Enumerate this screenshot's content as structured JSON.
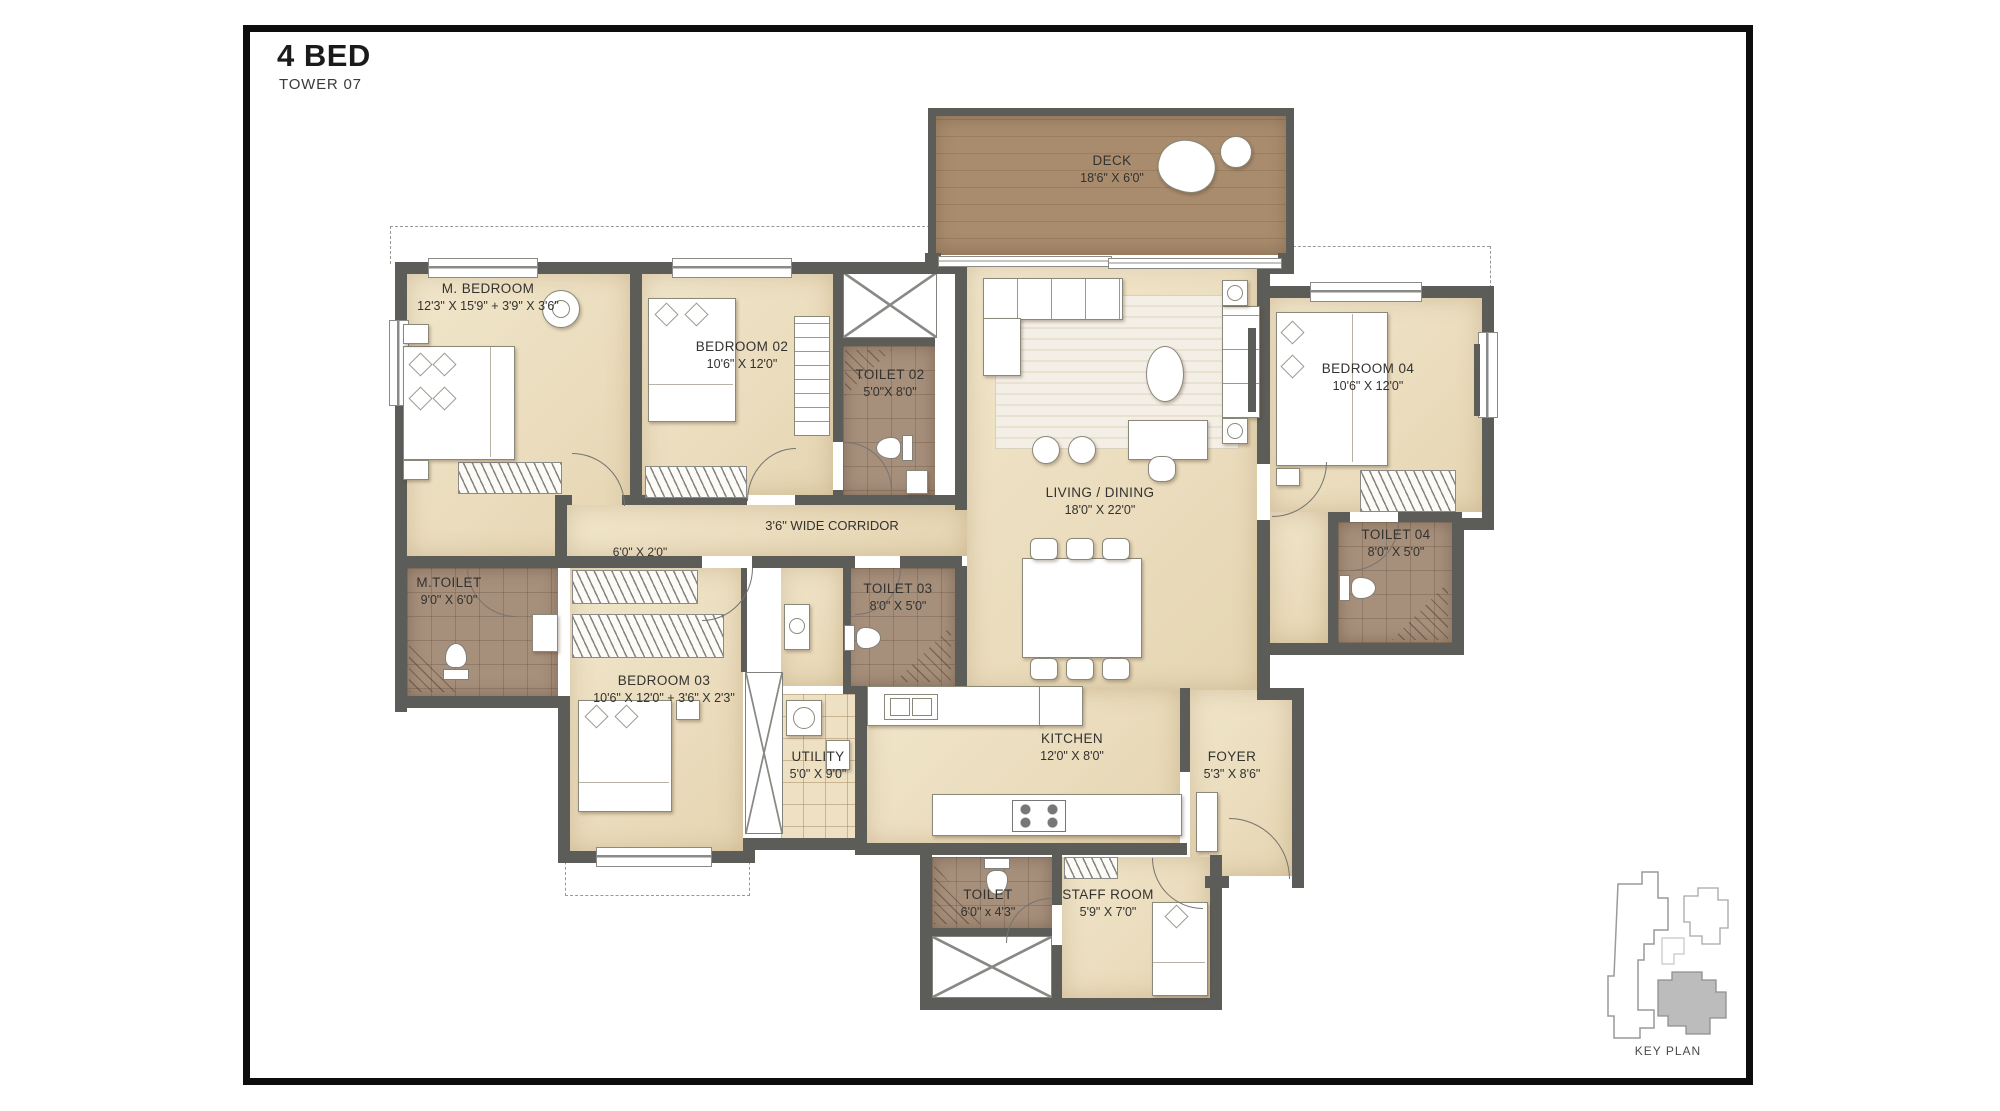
{
  "title": "4 BED",
  "subtitle": "TOWER 07",
  "rooms": {
    "m_bedroom": {
      "name": "M. BEDROOM",
      "dims": "12'3\" X 15'9\" + 3'9\" X 3'6\""
    },
    "bedroom02": {
      "name": "BEDROOM 02",
      "dims": "10'6\" X 12'0\""
    },
    "bedroom03": {
      "name": "BEDROOM 03",
      "dims": "10'6\" X 12'0\" + 3'6\" X 2'3\""
    },
    "bedroom04": {
      "name": "BEDROOM 04",
      "dims": "10'6\" X 12'0\""
    },
    "living": {
      "name": "LIVING / DINING",
      "dims": "18'0\" X 22'0\""
    },
    "deck": {
      "name": "DECK",
      "dims": "18'6\" X 6'0\""
    },
    "kitchen": {
      "name": "KITCHEN",
      "dims": "12'0\" X 8'0\""
    },
    "utility": {
      "name": "UTILITY",
      "dims": "5'0\" X 9'0\""
    },
    "foyer": {
      "name": "FOYER",
      "dims": "5'3\" X 8'6\""
    },
    "m_toilet": {
      "name": "M.TOILET",
      "dims": "9'0\" X 6'0\""
    },
    "toilet02": {
      "name": "TOILET 02",
      "dims": "5'0\"X 8'0\""
    },
    "toilet03": {
      "name": "TOILET 03",
      "dims": "8'0\" X 5'0\""
    },
    "toilet04": {
      "name": "TOILET 04",
      "dims": "8'0\" X 5'0\""
    },
    "toilet_st": {
      "name": "TOILET",
      "dims": "6'0\" x 4'3\""
    },
    "staff_room": {
      "name": "STAFF ROOM",
      "dims": "5'9\" X 7'0\""
    }
  },
  "corridor": {
    "name": "3'6\" WIDE CORRIDOR"
  },
  "wardrobe_dim": "6'0\" X 2'0\"",
  "key_plan": {
    "label": "KEY PLAN"
  },
  "colors": {
    "wall": "#5c5c58",
    "floor": "#ecdfc2",
    "toilet_tile": "#a68f7b",
    "deck_wood": "#a4886a",
    "key_highlight": "#bcbcbc",
    "frame_border": "#0d0d0d"
  }
}
